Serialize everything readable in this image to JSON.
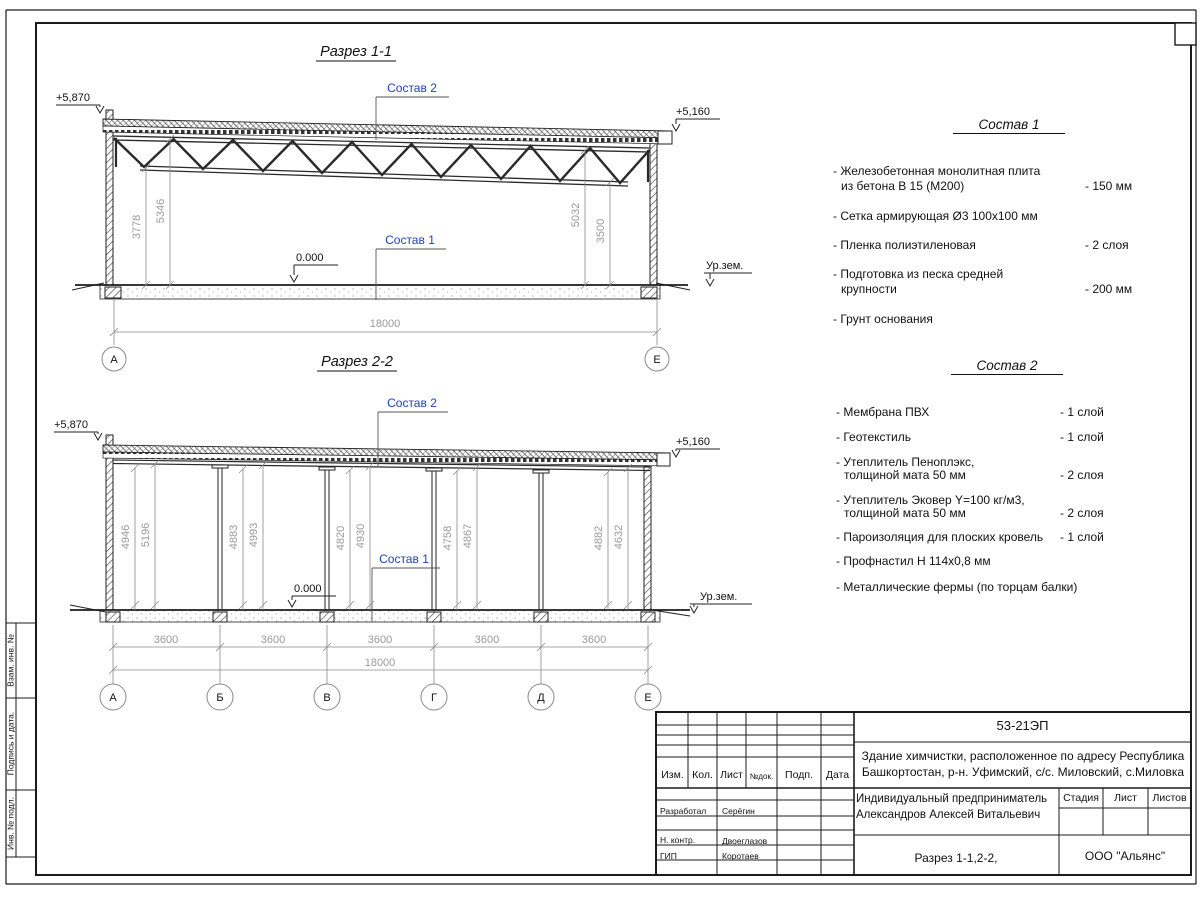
{
  "labels": {
    "elev_high": "+5,870",
    "elev_low": "+5,160",
    "zero": "0.000",
    "ground": "Ур.зем.",
    "ref1": "Состав 1",
    "ref2": "Состав 2"
  },
  "sections": {
    "s1": {
      "title": "Разрез 1-1",
      "dims": {
        "d1": "3778",
        "d2": "5346",
        "d3": "5032",
        "d4": "3500",
        "total": "18000"
      },
      "axes": [
        "А",
        "Е"
      ]
    },
    "s2": {
      "title": "Разрез 2-2",
      "heights": [
        "4946",
        "5196",
        "4883",
        "4993",
        "4820",
        "4930",
        "4758",
        "4867",
        "4882",
        "4632"
      ],
      "spans": [
        "3600",
        "3600",
        "3600",
        "3600",
        "3600"
      ],
      "total": "18000",
      "axes": [
        "А",
        "Б",
        "В",
        "Г",
        "Д",
        "Е"
      ]
    }
  },
  "sostav1": {
    "title": "Состав 1",
    "items": [
      {
        "l1": "- Железобетонная  монолитная плита",
        "l2": "из бетона В 15 (М200)",
        "v": "- 150 мм"
      },
      {
        "l1": "- Сетка армирующая Ø3 100х100 мм",
        "l2": "",
        "v": ""
      },
      {
        "l1": "- Пленка полиэтиленовая",
        "l2": "",
        "v": "-  2 слоя"
      },
      {
        "l1": "- Подготовка из песка средней",
        "l2": "крупности",
        "v": "- 200 мм"
      },
      {
        "l1": "- Грунт основания",
        "l2": "",
        "v": ""
      }
    ]
  },
  "sostav2": {
    "title": "Состав 2",
    "items": [
      {
        "l1": "- Мембрана ПВХ",
        "l2": "",
        "v": "- 1 слой"
      },
      {
        "l1": "- Геотекстиль",
        "l2": "",
        "v": "- 1 слой"
      },
      {
        "l1": "- Утеплитель Пеноплэкс,",
        "l2": "толщиной мата 50 мм",
        "v": "- 2 слоя"
      },
      {
        "l1": "- Утеплитель Эковер Y=100 кг/м3,",
        "l2": "толщиной мата 50 мм",
        "v": "- 2 слоя"
      },
      {
        "l1": "- Пароизоляция для плоских кровель",
        "l2": "",
        "v": "- 1 слой"
      },
      {
        "l1": "- Профнастил Н 114х0,8 мм",
        "l2": "",
        "v": ""
      },
      {
        "l1": "- Металлические фермы (по торцам балки)",
        "l2": "",
        "v": ""
      }
    ]
  },
  "titleblock": {
    "doc_number": "53-21ЭП",
    "object_line1": "Здание химчистки,  расположенное по адресу Республика",
    "object_line2": "Башкортостан, р-н. Уфимский, с/с. Миловский, с.Миловка",
    "cols": {
      "izm": "Изм.",
      "kol": "Кол.",
      "list": "Лист",
      "ndok": "№док.",
      "podp": "Подп.",
      "data": "Дата"
    },
    "roles": {
      "r1": "Разработал",
      "n1": "Серёгин",
      "r2": "Н. контр.",
      "n2": "Двоеглазов",
      "r3": "ГИП",
      "n3": "Коротаев"
    },
    "client_line1": "Индивидуальный предприниматель",
    "client_line2": "Александров Алексей Витальевич",
    "stage": "Стадия",
    "sheet": "Лист",
    "sheets": "Листов",
    "sheet_name": "Разрез 1-1,2-2,",
    "org": "ООО \"Альянс\""
  },
  "margin": {
    "c1": "Взам. инв. №",
    "c2": "Подпись  и  дата.",
    "c3": "Инв. № подл."
  },
  "colors": {
    "accent_blue": "#1a3fcf",
    "dim_gray": "#9a9a9a",
    "line": "#1b1b1b"
  }
}
